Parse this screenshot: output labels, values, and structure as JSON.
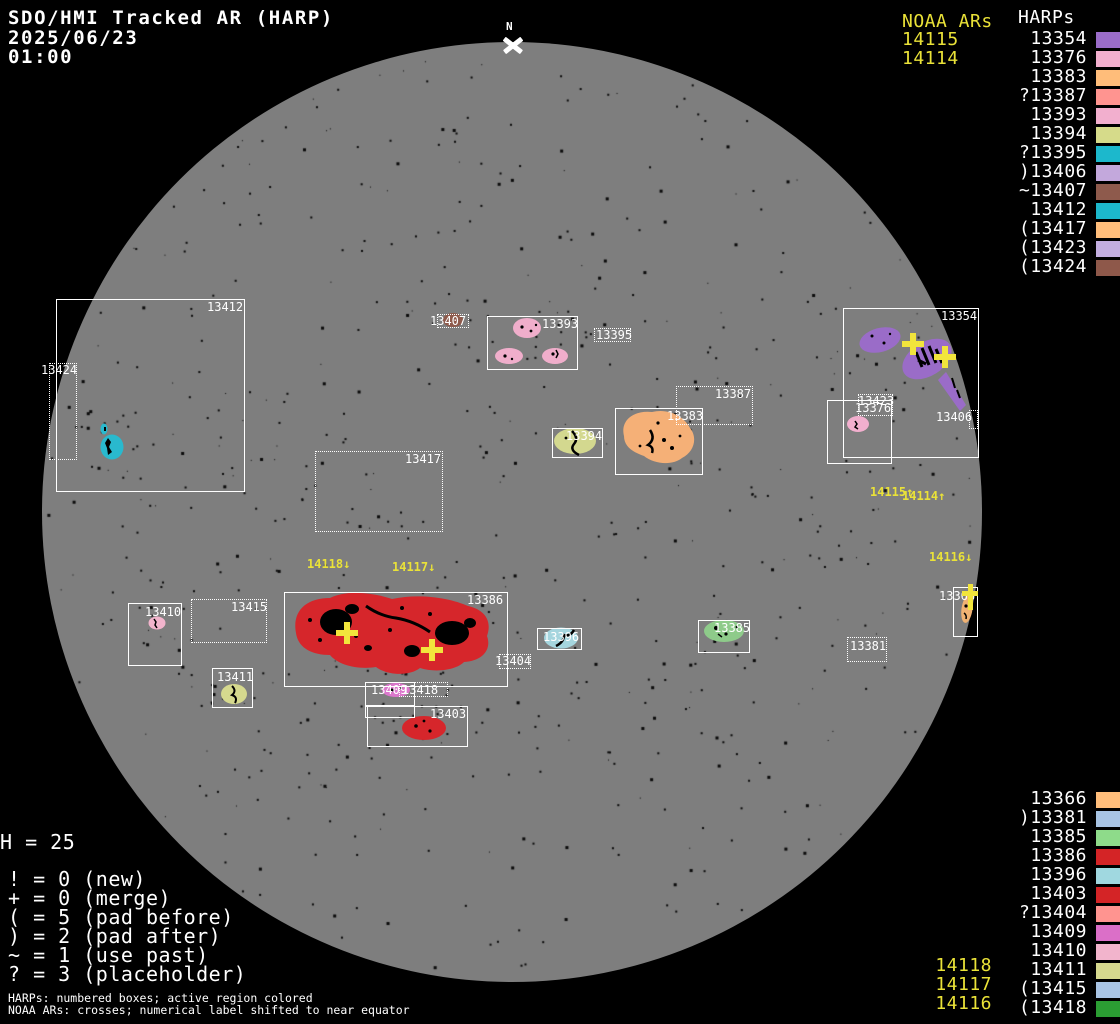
{
  "header": {
    "title": "SDO/HMI Tracked AR (HARP)",
    "date": "2025/06/23",
    "time": "01:00"
  },
  "compass": {
    "label": "N"
  },
  "panel_top": {
    "noaa_title": "NOAA ARs",
    "noaa_items": [
      "14115",
      "14114"
    ],
    "harps_title": "HARPs",
    "items": [
      {
        "prefix": "",
        "num": "13354",
        "color": "#9A6CC8"
      },
      {
        "prefix": "",
        "num": "13376",
        "color": "#F2AFCE"
      },
      {
        "prefix": "",
        "num": "13383",
        "color": "#FFBD7A"
      },
      {
        "prefix": "?",
        "num": "13387",
        "color": "#FF9490"
      },
      {
        "prefix": "",
        "num": "13393",
        "color": "#F2AFCE"
      },
      {
        "prefix": "",
        "num": "13394",
        "color": "#D6DB8A"
      },
      {
        "prefix": "?",
        "num": "13395",
        "color": "#1CB8CC"
      },
      {
        "prefix": ")",
        "num": "13406",
        "color": "#C3A8DC"
      },
      {
        "prefix": "~",
        "num": "13407",
        "color": "#8E5A4C"
      },
      {
        "prefix": "",
        "num": "13412",
        "color": "#1CB8CC"
      },
      {
        "prefix": "(",
        "num": "13417",
        "color": "#FFBD7A"
      },
      {
        "prefix": "(",
        "num": "13423",
        "color": "#C3AEE0"
      },
      {
        "prefix": "(",
        "num": "13424",
        "color": "#8E584A"
      }
    ]
  },
  "panel_bottom": {
    "noaa_items": [
      "14118",
      "14117",
      "14116"
    ],
    "items": [
      {
        "prefix": "",
        "num": "13366",
        "color": "#FFBD7A"
      },
      {
        "prefix": ")",
        "num": "13381",
        "color": "#A8C4E4"
      },
      {
        "prefix": "",
        "num": "13385",
        "color": "#8EDB8A"
      },
      {
        "prefix": "",
        "num": "13386",
        "color": "#D42426"
      },
      {
        "prefix": "",
        "num": "13396",
        "color": "#A0D8E0"
      },
      {
        "prefix": "",
        "num": "13403",
        "color": "#D42426"
      },
      {
        "prefix": "?",
        "num": "13404",
        "color": "#FF9490"
      },
      {
        "prefix": "",
        "num": "13409",
        "color": "#DB6FC8"
      },
      {
        "prefix": "",
        "num": "13410",
        "color": "#F2B4CC"
      },
      {
        "prefix": "",
        "num": "13411",
        "color": "#D6D98E"
      },
      {
        "prefix": "(",
        "num": "13415",
        "color": "#A8C4E4"
      },
      {
        "prefix": "(",
        "num": "13418",
        "color": "#2B9E33"
      }
    ]
  },
  "legend": {
    "h_count": "H = 25",
    "lines": [
      "! = 0 (new)",
      "+ = 0 (merge)",
      "( = 5 (pad before)",
      ") = 2 (pad after)",
      "~ = 1 (use past)",
      "? = 3 (placeholder)"
    ]
  },
  "footer": {
    "line1": "HARPs: numbered boxes; active region colored",
    "line2": "NOAA ARs: crosses; numerical label shifted to near equator"
  },
  "disk": {
    "boxes": [
      {
        "label": "13412",
        "x": 56,
        "y": 299,
        "w": 189,
        "h": 193,
        "dotted": false,
        "lx": 207,
        "ly": 301
      },
      {
        "label": "13424",
        "x": 49,
        "y": 363,
        "w": 28,
        "h": 97,
        "dotted": true,
        "lx": 41,
        "ly": 364
      },
      {
        "label": "13407",
        "x": 437,
        "y": 314,
        "w": 32,
        "h": 14,
        "dotted": true,
        "lx": 430,
        "ly": 315
      },
      {
        "label": "13393",
        "x": 487,
        "y": 316,
        "w": 91,
        "h": 54,
        "dotted": false,
        "lx": 542,
        "ly": 318
      },
      {
        "label": "13395",
        "x": 594,
        "y": 328,
        "w": 37,
        "h": 14,
        "dotted": true,
        "lx": 596,
        "ly": 329
      },
      {
        "label": "13387",
        "x": 676,
        "y": 386,
        "w": 77,
        "h": 39,
        "dotted": true,
        "lx": 715,
        "ly": 388
      },
      {
        "label": "13383",
        "x": 615,
        "y": 408,
        "w": 88,
        "h": 67,
        "dotted": false,
        "lx": 667,
        "ly": 410
      },
      {
        "label": "13394",
        "x": 552,
        "y": 428,
        "w": 51,
        "h": 30,
        "dotted": false,
        "lx": 566,
        "ly": 430
      },
      {
        "label": "13354",
        "x": 843,
        "y": 308,
        "w": 136,
        "h": 150,
        "dotted": false,
        "lx": 941,
        "ly": 310
      },
      {
        "label": "13376",
        "x": 827,
        "y": 400,
        "w": 65,
        "h": 64,
        "dotted": false,
        "lx": 855,
        "ly": 402
      },
      {
        "label": "13423",
        "x": 858,
        "y": 394,
        "w": 35,
        "h": 22,
        "dotted": true,
        "lx": 858,
        "ly": 395
      },
      {
        "label": "13406",
        "x": 969,
        "y": 410,
        "w": 9,
        "h": 19,
        "dotted": true,
        "lx": 936,
        "ly": 411
      },
      {
        "label": "13417",
        "x": 315,
        "y": 451,
        "w": 128,
        "h": 81,
        "dotted": true,
        "lx": 405,
        "ly": 453
      },
      {
        "label": "13415",
        "x": 191,
        "y": 599,
        "w": 76,
        "h": 44,
        "dotted": true,
        "lx": 231,
        "ly": 601
      },
      {
        "label": "13410",
        "x": 128,
        "y": 603,
        "w": 54,
        "h": 63,
        "dotted": false,
        "lx": 145,
        "ly": 606
      },
      {
        "label": "13386",
        "x": 284,
        "y": 592,
        "w": 224,
        "h": 95,
        "dotted": false,
        "lx": 467,
        "ly": 594
      },
      {
        "label": "13404",
        "x": 499,
        "y": 654,
        "w": 32,
        "h": 15,
        "dotted": true,
        "lx": 495,
        "ly": 655
      },
      {
        "label": "13411",
        "x": 212,
        "y": 668,
        "w": 41,
        "h": 40,
        "dotted": false,
        "lx": 217,
        "ly": 671
      },
      {
        "label": "13409",
        "x": 365,
        "y": 682,
        "w": 50,
        "h": 24,
        "dotted": false,
        "lx": 371,
        "ly": 684
      },
      {
        "label": "",
        "x": 365,
        "y": 706,
        "w": 50,
        "h": 12,
        "dotted": false,
        "lx": 0,
        "ly": 0
      },
      {
        "label": "13418",
        "x": 399,
        "y": 682,
        "w": 49,
        "h": 15,
        "dotted": true,
        "lx": 402,
        "ly": 684
      },
      {
        "label": "13403",
        "x": 367,
        "y": 706,
        "w": 101,
        "h": 41,
        "dotted": false,
        "lx": 430,
        "ly": 708
      },
      {
        "label": "13385",
        "x": 698,
        "y": 620,
        "w": 52,
        "h": 33,
        "dotted": false,
        "lx": 714,
        "ly": 622
      },
      {
        "label": "13381",
        "x": 847,
        "y": 637,
        "w": 40,
        "h": 25,
        "dotted": true,
        "lx": 850,
        "ly": 640
      },
      {
        "label": "13396",
        "x": 537,
        "y": 628,
        "w": 45,
        "h": 22,
        "dotted": false,
        "lx": 543,
        "ly": 631
      },
      {
        "label": "13366",
        "x": 953,
        "y": 587,
        "w": 25,
        "h": 50,
        "dotted": false,
        "lx": 939,
        "ly": 590
      }
    ],
    "noaa_labels": [
      {
        "text": "14118↓",
        "x": 307,
        "y": 558
      },
      {
        "text": "14117↓",
        "x": 392,
        "y": 561
      },
      {
        "text": "14115↑",
        "x": 870,
        "y": 486
      },
      {
        "text": "14114↑",
        "x": 902,
        "y": 490
      },
      {
        "text": "14116↓",
        "x": 929,
        "y": 551
      }
    ],
    "crosses": [
      {
        "x": 347,
        "y": 633
      },
      {
        "x": 432,
        "y": 650
      },
      {
        "x": 913,
        "y": 344
      },
      {
        "x": 945,
        "y": 357
      },
      {
        "x": 970,
        "y": 597,
        "tall": true
      }
    ]
  },
  "colors": {
    "h13354": "#9A6CC8",
    "h13366": "#F0B273",
    "h13376": "#F2AFCE",
    "h13383": "#F5B077",
    "h13385": "#8ECB8A",
    "h13386": "#D6262B",
    "h13393": "#F0AECB",
    "h13394": "#D3D88F",
    "h13396": "#A5D5DE",
    "h13403": "#D6262B",
    "h13407": "#8E5A4C",
    "h13409": "#DB77CC",
    "h13410": "#F2B4CC",
    "h13411": "#D6D98E",
    "h13412": "#29B9CE"
  }
}
